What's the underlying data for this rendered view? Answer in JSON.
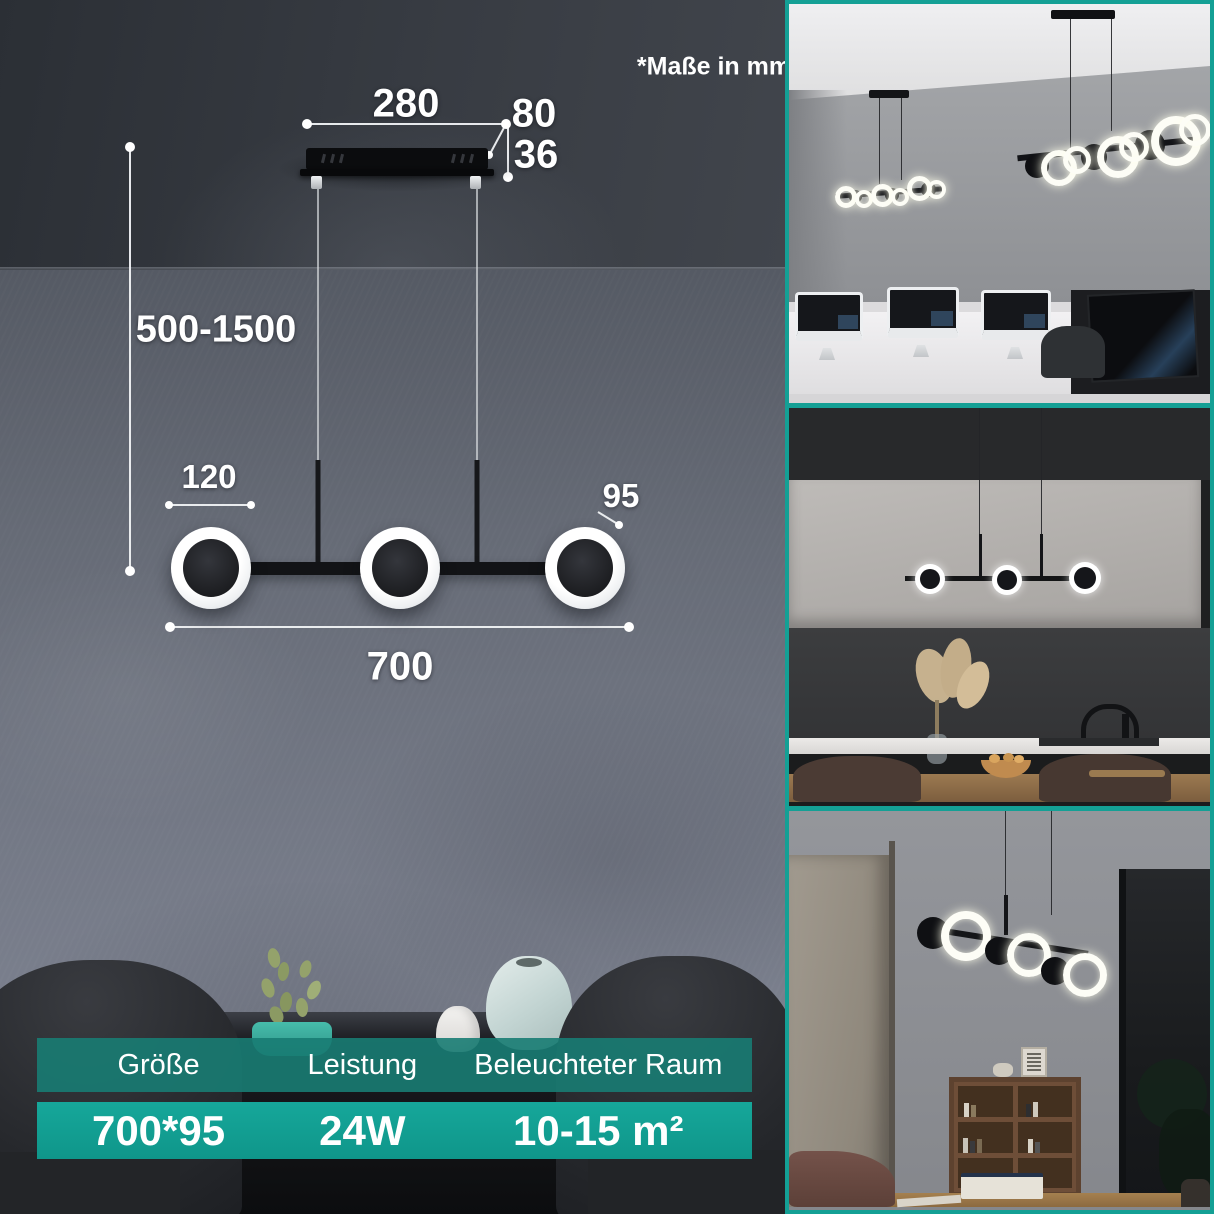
{
  "note": "*Maße in mm",
  "diagram": {
    "mount_width": "280",
    "mount_depth": "80",
    "mount_height": "36",
    "cable_range": "500-1500",
    "head_diameter": "120",
    "head_size": "95",
    "fixture_length": "700"
  },
  "spec_table": {
    "headers": [
      "Größe",
      "Leistung",
      "Beleuchteter Raum"
    ],
    "values": [
      "700*95",
      "24W",
      "10-15 m²"
    ]
  },
  "colors": {
    "accent_teal": "#14a095",
    "table_header_teal": "#187c73",
    "table_value_teal": "#12a093",
    "wall_gray": "#747986",
    "ceiling_gray": "#383c43"
  },
  "photos": [
    {
      "scene": "office-with-imacs"
    },
    {
      "scene": "kitchen-counter"
    },
    {
      "scene": "home-study"
    }
  ]
}
